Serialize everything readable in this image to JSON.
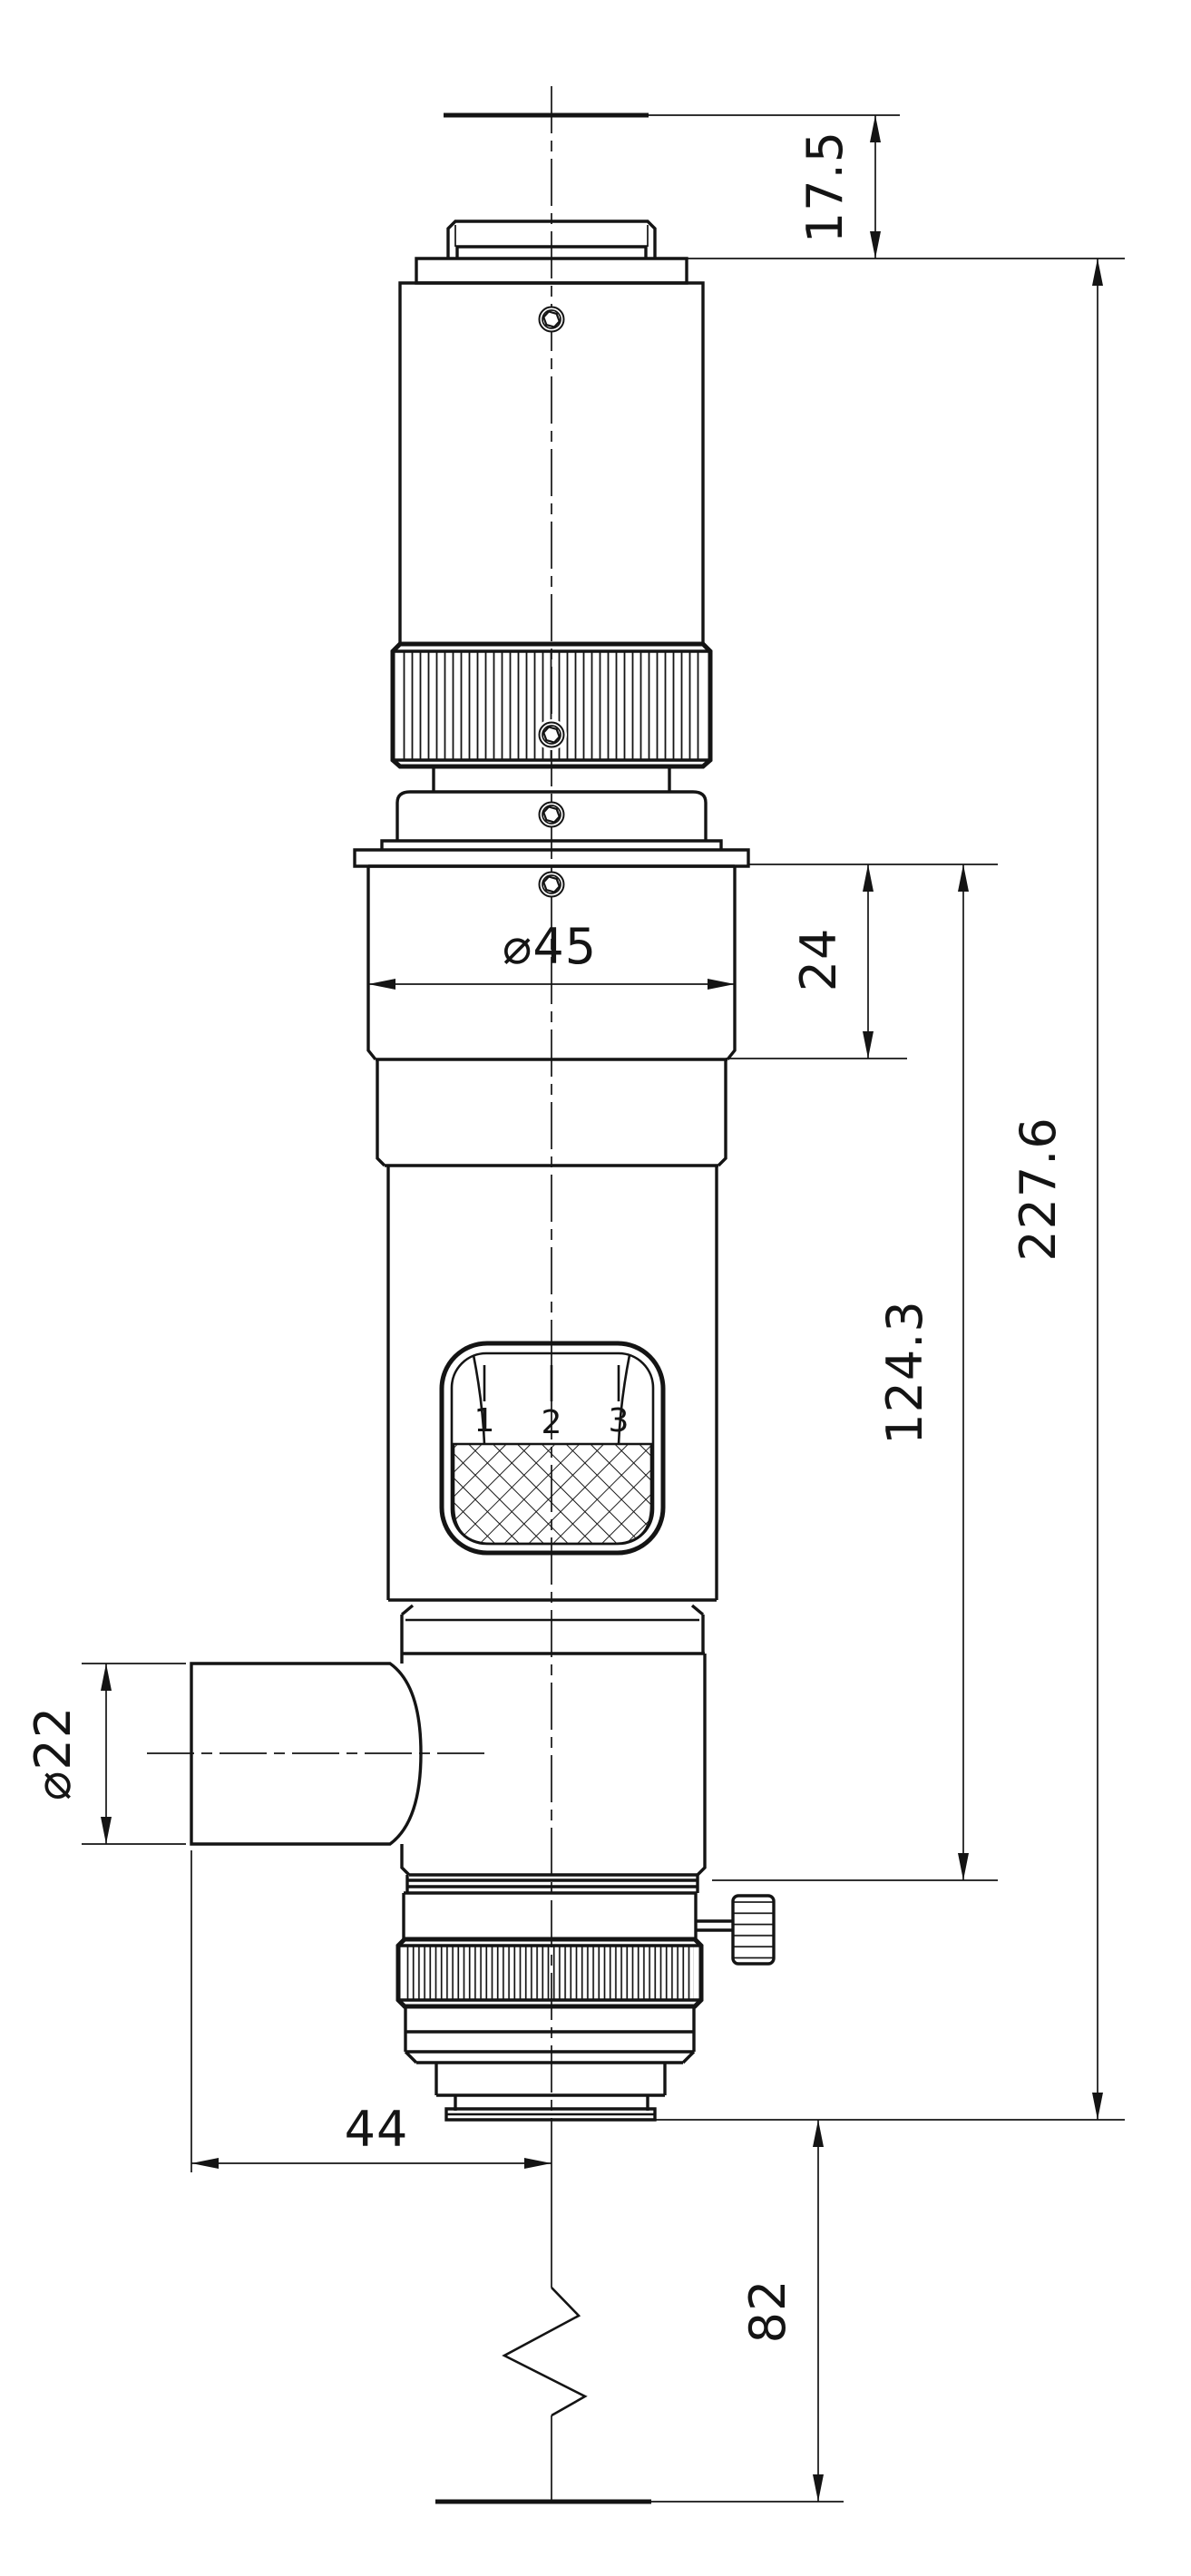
{
  "meta": {
    "kind": "technical-drawing",
    "view": "side-elevation-with-dimensions",
    "units": "mm"
  },
  "colors": {
    "ink": "#141414",
    "paper": "#ffffff"
  },
  "dimensions": {
    "top_offset": "17.5",
    "upper_section": "24",
    "overall_length": "227.6",
    "mid_length": "124.3",
    "body_diameter": "⌀45",
    "port_diameter": "⌀22",
    "port_offset": "44",
    "lower_extension": "82"
  },
  "turret": {
    "pos1": "1",
    "pos2": "2",
    "pos3": "3"
  }
}
